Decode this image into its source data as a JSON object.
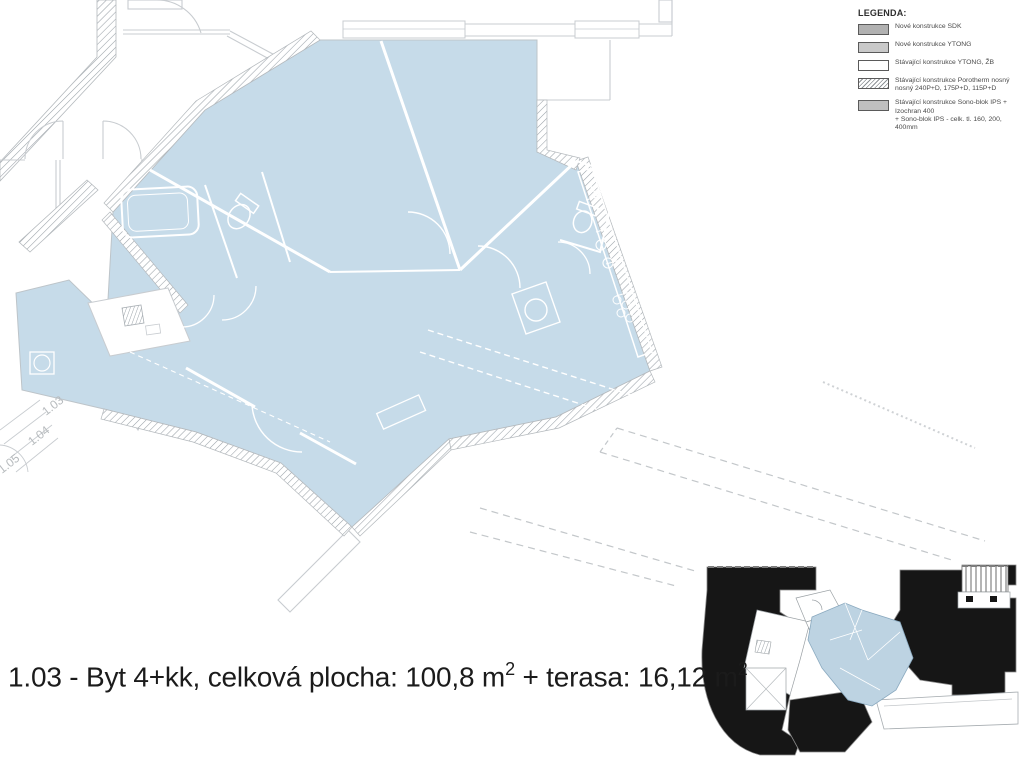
{
  "legend": {
    "title": "LEGENDA:",
    "items": [
      {
        "label": "Nové konstrukce SDK",
        "label2": ""
      },
      {
        "label": "Nové konstrukce YTONG",
        "label2": ""
      },
      {
        "label": "Stávající konstrukce YTONG, ŽB",
        "label2": ""
      },
      {
        "label": "Stávající konstrukce Porotherm nosný",
        "label2": "nosný 240P+D, 175P+D, 115P+D"
      },
      {
        "label": "Stávající konstrukce Sono-blok IPS + Izochran 400",
        "label2": "+ Sono-blok IPS - celk. tl. 160, 200, 400mm"
      }
    ]
  },
  "caption": {
    "part1": "1.03 - Byt 4+kk, celková plocha: 100,8 m",
    "sup1": "2",
    "part2": " + terasa: 16,12 m",
    "sup2": "2"
  },
  "plan": {
    "room_labels": [
      "1.03",
      "1.04",
      "1.05"
    ]
  },
  "colors": {
    "apartment_fill": "#c6dbe9",
    "wall_line": "#c8ccd0",
    "hatch_line": "#9aa2a8",
    "minimap_building": "#161616",
    "minimap_apartment": "#bdd3e2"
  }
}
